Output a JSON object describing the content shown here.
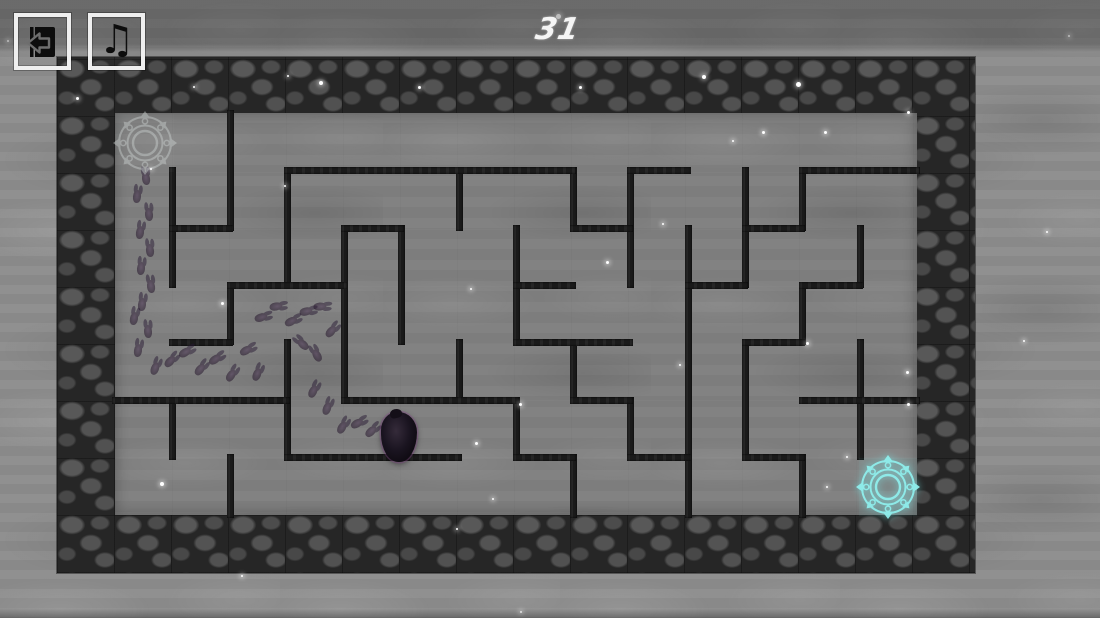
{
  "hud": {
    "level": "31",
    "music_icon_glyph": "♫"
  },
  "colors": {
    "wall": "#1a1a1a",
    "start_portal": "#cdd3d2",
    "goal_portal": "#8ff0ee",
    "star": "#ffffff",
    "hud_text": "#f5f5f5",
    "button_border": "#efefef",
    "icon": "#0d0d0d"
  },
  "maze": {
    "border": {
      "x": 57,
      "y": 57,
      "width": 918,
      "height": 516
    },
    "interior": {
      "x": 115,
      "y": 113,
      "width": 802,
      "height": 402
    },
    "wall_thickness": 7,
    "vertical_walls": [
      [
        230,
        113,
        228
      ],
      [
        172,
        170,
        285
      ],
      [
        287,
        170,
        285
      ],
      [
        459,
        170,
        228
      ],
      [
        573,
        170,
        228
      ],
      [
        630,
        170,
        285
      ],
      [
        745,
        170,
        285
      ],
      [
        802,
        170,
        228
      ],
      [
        401,
        228,
        342
      ],
      [
        516,
        228,
        342
      ],
      [
        344,
        228,
        400
      ],
      [
        860,
        228,
        285
      ],
      [
        688,
        228,
        515
      ],
      [
        230,
        285,
        342
      ],
      [
        802,
        285,
        342
      ],
      [
        287,
        342,
        457
      ],
      [
        459,
        342,
        400
      ],
      [
        573,
        342,
        400
      ],
      [
        745,
        342,
        457
      ],
      [
        860,
        342,
        457
      ],
      [
        172,
        400,
        457
      ],
      [
        630,
        400,
        457
      ],
      [
        516,
        400,
        457
      ],
      [
        230,
        457,
        515
      ],
      [
        573,
        457,
        515
      ],
      [
        802,
        457,
        515
      ]
    ],
    "horizontal_walls": [
      [
        170,
        287,
        573
      ],
      [
        170,
        630,
        688
      ],
      [
        170,
        802,
        917
      ],
      [
        228,
        172,
        230
      ],
      [
        228,
        344,
        401
      ],
      [
        228,
        573,
        630
      ],
      [
        228,
        745,
        802
      ],
      [
        285,
        230,
        344
      ],
      [
        285,
        516,
        573
      ],
      [
        285,
        688,
        745
      ],
      [
        285,
        802,
        860
      ],
      [
        342,
        172,
        230
      ],
      [
        342,
        516,
        630
      ],
      [
        342,
        745,
        802
      ],
      [
        400,
        115,
        287
      ],
      [
        400,
        344,
        516
      ],
      [
        400,
        573,
        630
      ],
      [
        400,
        802,
        917
      ],
      [
        457,
        287,
        459
      ],
      [
        457,
        516,
        573
      ],
      [
        457,
        630,
        688
      ],
      [
        457,
        745,
        802
      ]
    ]
  },
  "portals": {
    "start": {
      "x": 145,
      "y": 143
    },
    "goal": {
      "x": 888,
      "y": 487
    }
  },
  "player": {
    "x": 399,
    "y": 437
  },
  "footprints": [
    [
      146,
      178,
      -8
    ],
    [
      137,
      196,
      6
    ],
    [
      149,
      214,
      -5
    ],
    [
      140,
      232,
      8
    ],
    [
      150,
      250,
      -6
    ],
    [
      141,
      268,
      5
    ],
    [
      151,
      286,
      -8
    ],
    [
      142,
      304,
      6
    ],
    [
      134,
      318,
      10
    ],
    [
      148,
      331,
      -4
    ],
    [
      138,
      350,
      8
    ],
    [
      155,
      368,
      20
    ],
    [
      170,
      361,
      42
    ],
    [
      185,
      352,
      58
    ],
    [
      200,
      369,
      38
    ],
    [
      215,
      359,
      55
    ],
    [
      231,
      375,
      32
    ],
    [
      246,
      350,
      60
    ],
    [
      261,
      317,
      72
    ],
    [
      276,
      306,
      80
    ],
    [
      291,
      321,
      62
    ],
    [
      306,
      311,
      76
    ],
    [
      320,
      306,
      85
    ],
    [
      331,
      331,
      40
    ],
    [
      317,
      355,
      -30
    ],
    [
      303,
      344,
      -48
    ],
    [
      257,
      374,
      22
    ],
    [
      313,
      391,
      26
    ],
    [
      327,
      408,
      20
    ],
    [
      342,
      427,
      30
    ],
    [
      357,
      423,
      60
    ],
    [
      371,
      431,
      46
    ]
  ],
  "stars": [
    [
      558,
      16,
      5
    ],
    [
      77,
      98,
      3
    ],
    [
      194,
      87,
      2
    ],
    [
      288,
      76,
      2
    ],
    [
      321,
      83,
      4
    ],
    [
      419,
      87,
      3
    ],
    [
      580,
      87,
      3
    ],
    [
      704,
      77,
      4
    ],
    [
      798,
      84,
      5
    ],
    [
      908,
      112,
      3
    ],
    [
      151,
      169,
      2
    ],
    [
      285,
      186,
      2
    ],
    [
      733,
      141,
      2
    ],
    [
      763,
      132,
      3
    ],
    [
      825,
      132,
      3
    ],
    [
      607,
      262,
      3
    ],
    [
      471,
      289,
      2
    ],
    [
      222,
      303,
      3
    ],
    [
      520,
      404,
      3
    ],
    [
      680,
      365,
      2
    ],
    [
      907,
      372,
      3
    ],
    [
      908,
      404,
      3
    ],
    [
      476,
      443,
      3
    ],
    [
      162,
      484,
      4
    ],
    [
      457,
      529,
      2
    ],
    [
      242,
      576,
      2
    ],
    [
      807,
      343,
      3
    ],
    [
      827,
      487,
      2
    ],
    [
      493,
      499,
      2
    ],
    [
      1069,
      36,
      2
    ],
    [
      1047,
      232,
      2
    ],
    [
      1024,
      341,
      2
    ],
    [
      8,
      41,
      2
    ],
    [
      663,
      224,
      2
    ],
    [
      847,
      457,
      2
    ],
    [
      521,
      612,
      2
    ]
  ]
}
